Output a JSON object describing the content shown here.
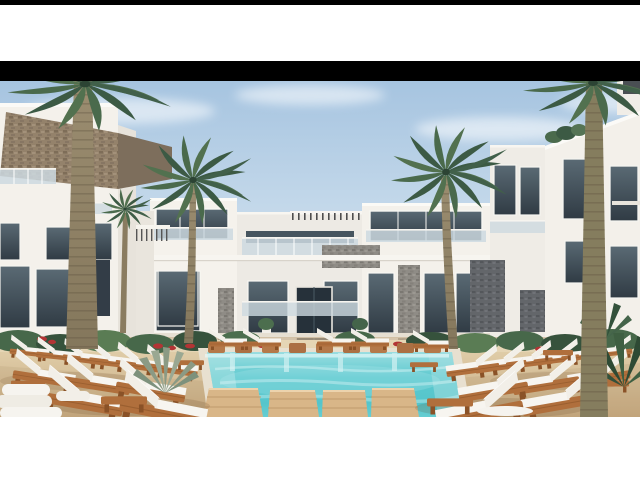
{
  "window": {
    "width": 640,
    "height": 480
  },
  "frame": {
    "top_strip_color": "#000000",
    "letterbox_color": "#000000",
    "margin_color": "#ffffff"
  },
  "photo": {
    "kind": "architectural-render",
    "subject": "Courtyard of a modern white resort apartment complex with a turquoise swimming pool, palm trees and rows of white sun loungers on wooden frames",
    "elements": [
      "sky with soft clouds",
      "left building with brown stone cladding and glass balconies",
      "central three-storey building with pergola, glass balconies and stone accents",
      "right white buildings with dark window frames and rooftop shrubs",
      "tall palm trunks at both edges",
      "two large palms flanking the central building",
      "swimming pool with in-pool wooden benches, water features and wooden platforms",
      "rows of sun loungers with white cushions",
      "wooden side benches",
      "tropical plants with red flowers",
      "agave plant",
      "stacked white towels",
      "sandy pool deck"
    ],
    "palette": {
      "sky_top": "#a6c4e0",
      "sky_low": "#e6eef4",
      "wall_white": "#f4f1eb",
      "wall_shade": "#e7e3db",
      "stone_brown": "#94826b",
      "stone_gray": "#8f8c86",
      "stone_dark": "#63666a",
      "accent_dark": "#39424c",
      "window_glass": "#303b44",
      "balcony_glass": "#cdd9e0",
      "deck_sand": "#decaa6",
      "pool_water": "#5cc9cf",
      "pool_light": "#c8eeee",
      "lounger_wood": "#b06f3c",
      "lounger_wood_dark": "#8a5227",
      "cushion_white": "#f7f5f0",
      "palm_green_dark": "#3c5a44",
      "palm_green_light": "#52714f",
      "trunk": "#96886c",
      "bush_green": "#47684a",
      "flower_red": "#b23434"
    }
  }
}
